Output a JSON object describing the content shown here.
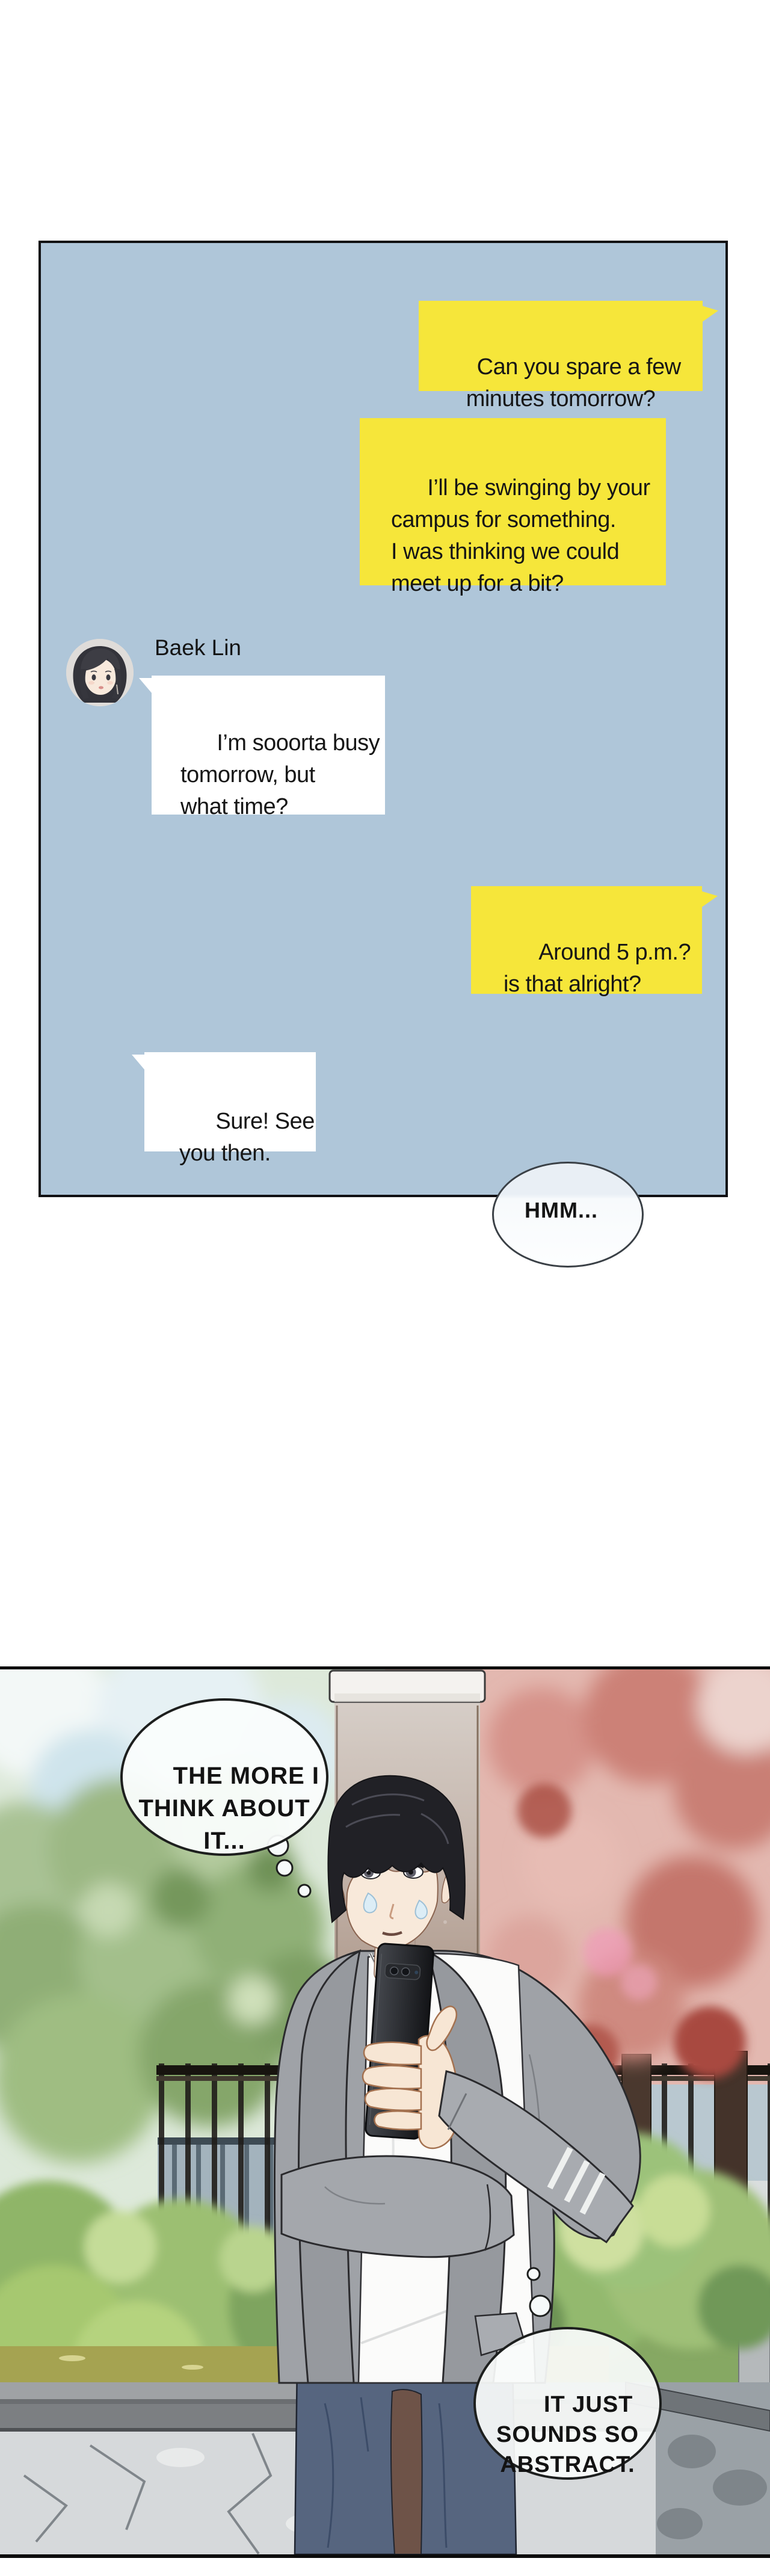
{
  "chat": {
    "contact": {
      "name": "Baek Lin"
    },
    "messages": [
      {
        "from": "sender",
        "style": "yellow",
        "text": "Can you spare a few\nminutes tomorrow?"
      },
      {
        "from": "sender",
        "style": "yellow",
        "text": "I’ll be swinging by your\ncampus for something.\nI was thinking we could\nmeet up for a bit?"
      },
      {
        "from": "contact",
        "style": "white",
        "text": "I’m sooorta busy\ntomorrow, but\nwhat time?"
      },
      {
        "from": "sender",
        "style": "yellow",
        "text": "Around 5 p.m.?\nis that alright?"
      },
      {
        "from": "contact",
        "style": "white",
        "text": "Sure! See\nyou then."
      }
    ],
    "reaction": {
      "text": "HMM..."
    },
    "colors": {
      "panel_bg": "#afc6d9",
      "panel_border": "#101013",
      "bubble_yellow": "#f6e63a",
      "bubble_white": "#ffffff",
      "text": "#161616"
    }
  },
  "comic": {
    "thoughts": [
      {
        "text": "THE MORE I\nTHINK ABOUT\nIT..."
      },
      {
        "text": "IT JUST\nSOUNDS SO\nABSTRACT."
      }
    ],
    "colors": {
      "foliage_left_green": "#9cb884",
      "foliage_right_pink": "#cc8177",
      "pillar_top": "#d9d2cc",
      "pillar_bottom": "#6e5246",
      "bush_green": "#8fb567",
      "grass": "#a5a351",
      "wall_face": "#d6d9db",
      "cardigan_gray": "#9fa2a7",
      "tshirt_white": "#fbfbfa",
      "jeans_blue": "#56657f",
      "phone_black": "#131417",
      "skin": "#f8e9da",
      "hair_black": "#212126"
    }
  }
}
